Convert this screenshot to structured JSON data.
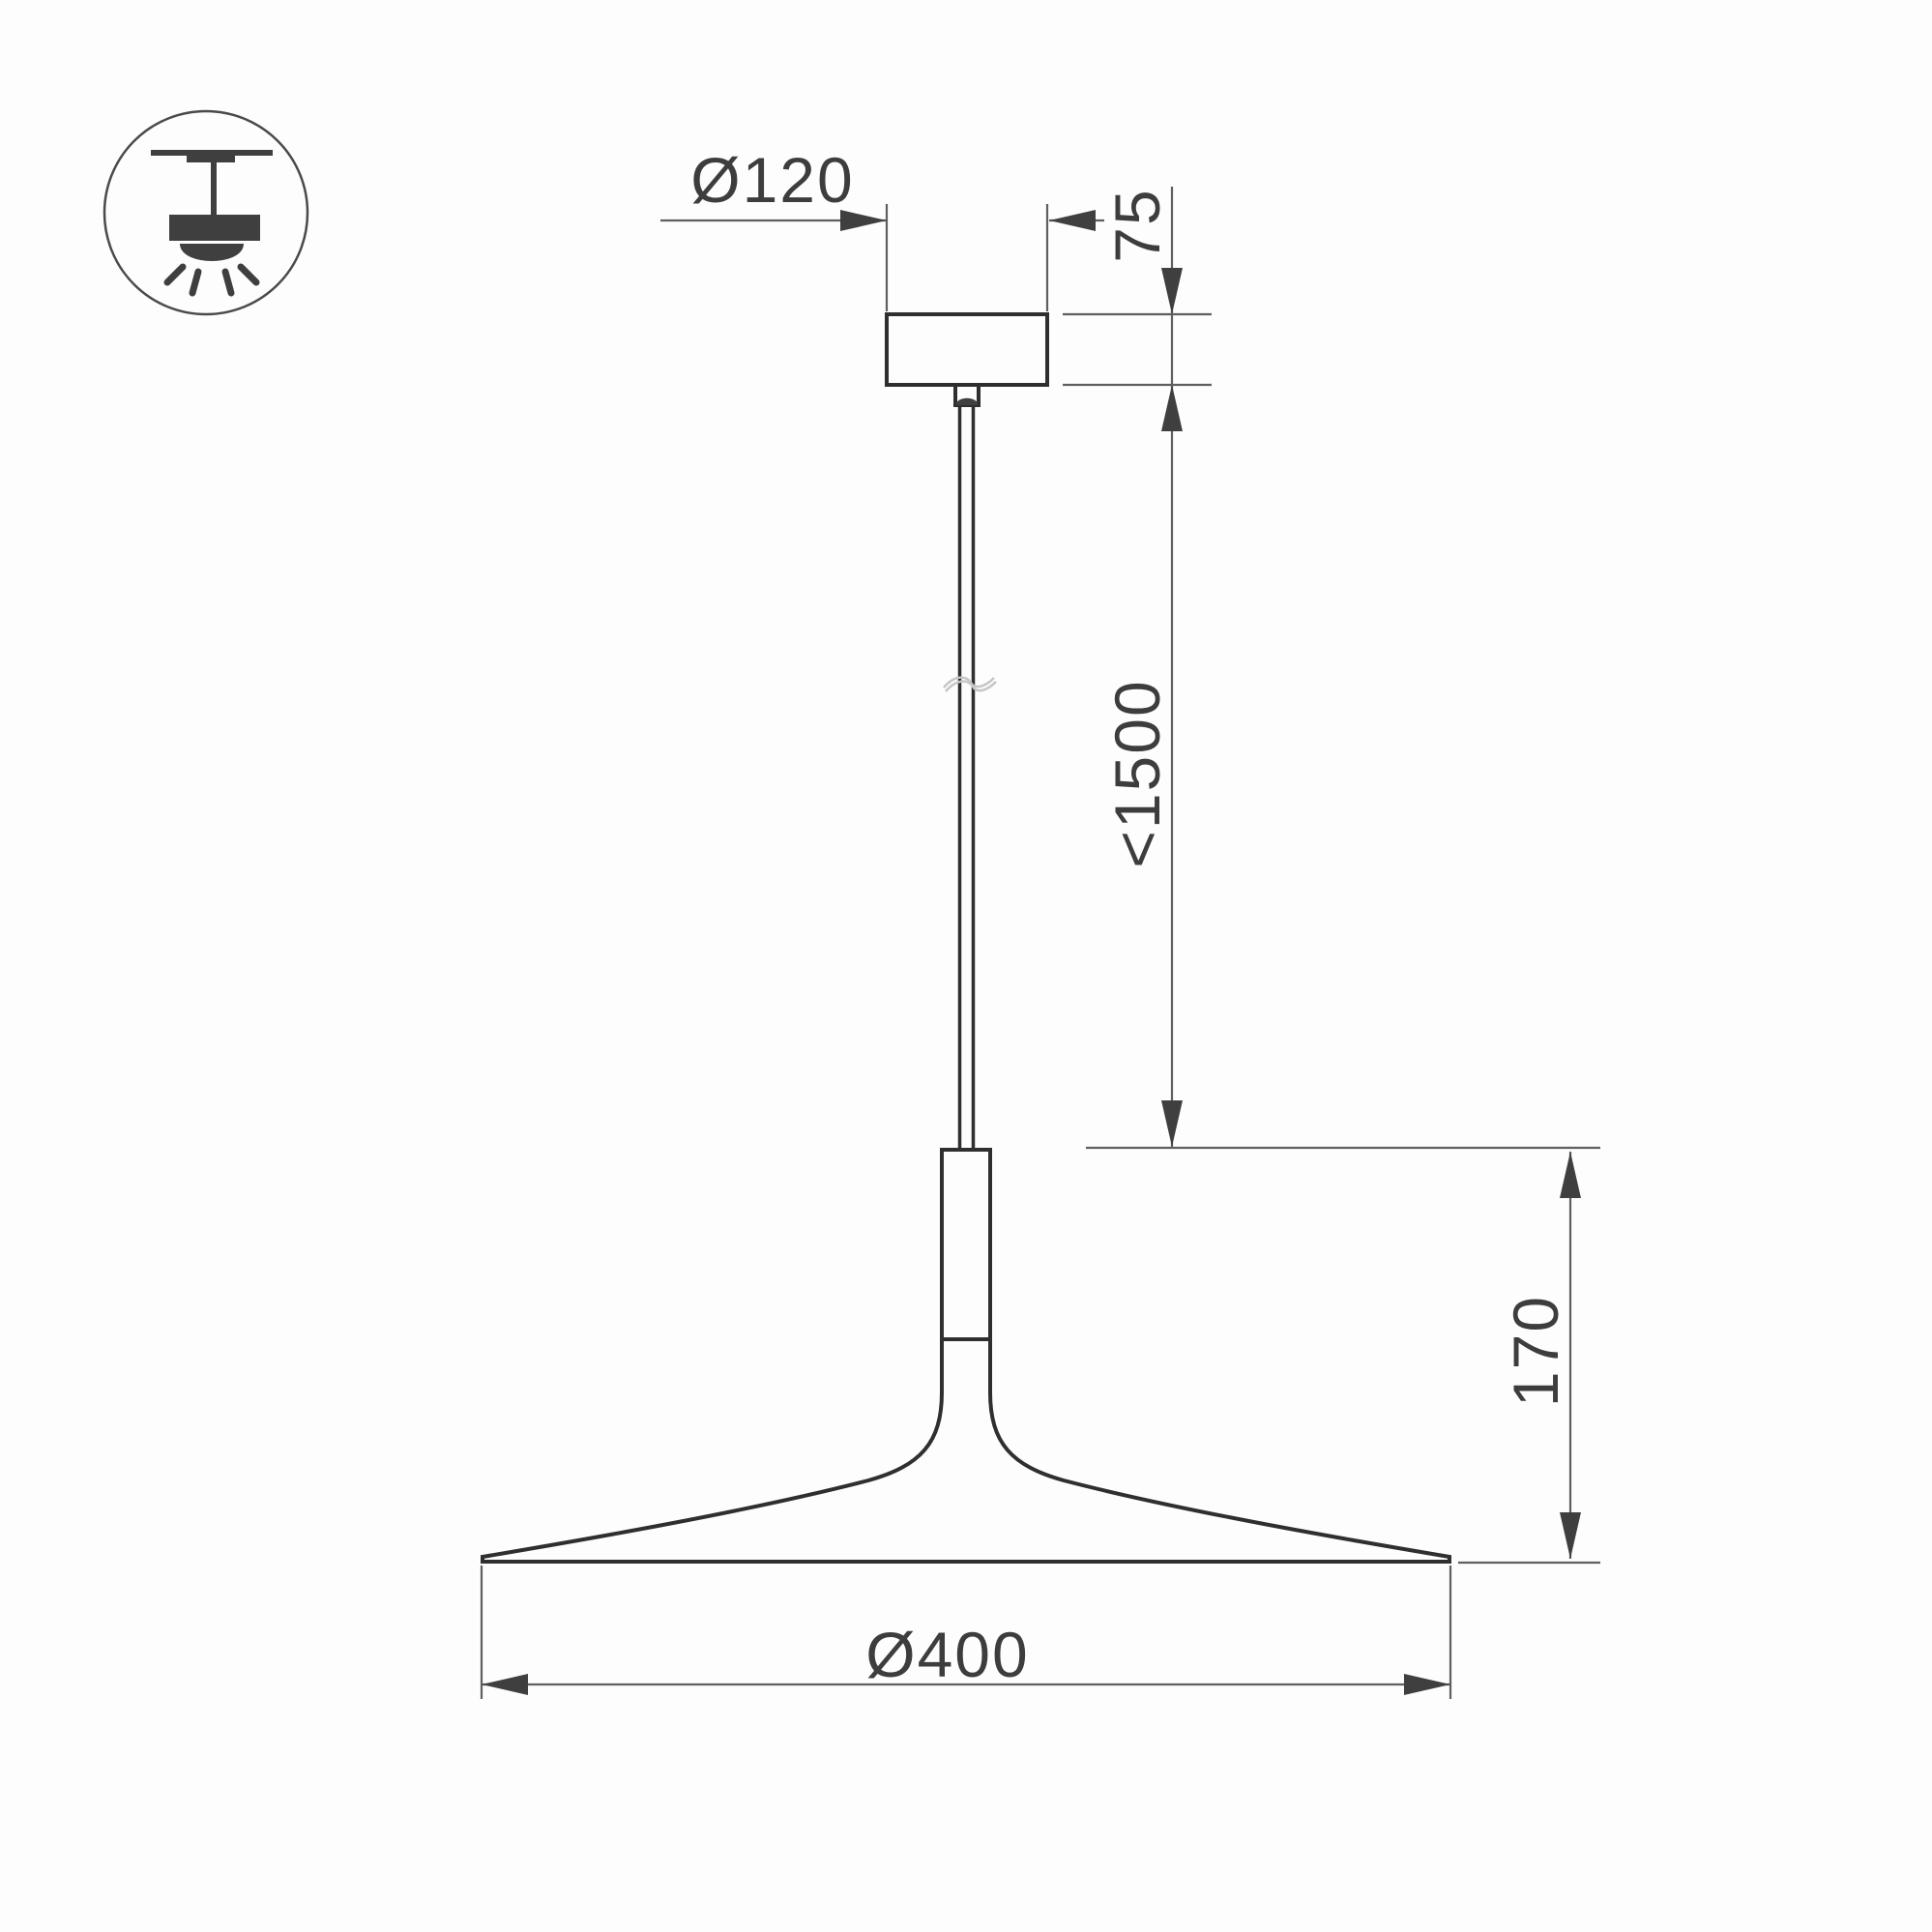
{
  "drawing": {
    "title": "pendant-lamp-dimension-drawing",
    "icon": "ceiling-pendant-light-icon",
    "dimensions": {
      "canopy_diameter": "Ø120",
      "canopy_height": "75",
      "suspension_length": "<1500",
      "shade_height": "170",
      "shade_diameter": "Ø400"
    },
    "colors": {
      "background": "#fdfdfd",
      "outline": "#2f2f2f",
      "dimension_line": "#5f5f5f",
      "arrow": "#3f3f3f",
      "text": "#3d3d3d",
      "break_mark": "#c6c6c6"
    }
  }
}
